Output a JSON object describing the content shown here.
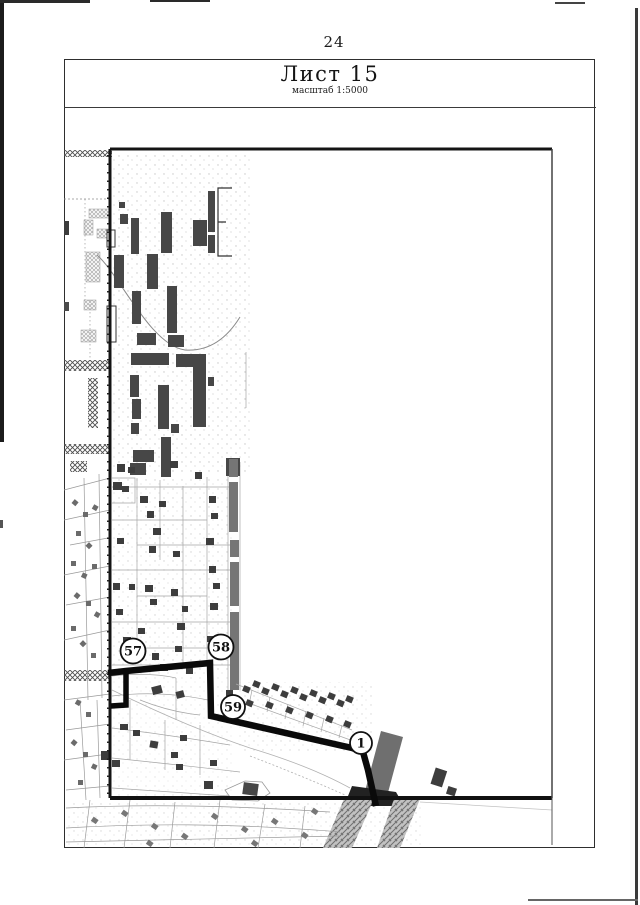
{
  "page": {
    "number": "24"
  },
  "sheet": {
    "title": "Лист 15",
    "scale_label": "масштаб 1:5000"
  },
  "map": {
    "boundary_points": [
      {
        "label": "57",
        "x": 133,
        "y": 651
      },
      {
        "label": "58",
        "x": 221,
        "y": 647
      },
      {
        "label": "59",
        "x": 233,
        "y": 707
      },
      {
        "label": "1",
        "x": 361,
        "y": 743
      }
    ]
  },
  "colors": {
    "paper": "#ffffff",
    "ink": "#1a1a1a",
    "boundary_line": "#0a0a0a",
    "building": "#474747",
    "small_building": "#3d3d3d",
    "road": "#757575",
    "parcel_line": "#9a9a9a"
  }
}
